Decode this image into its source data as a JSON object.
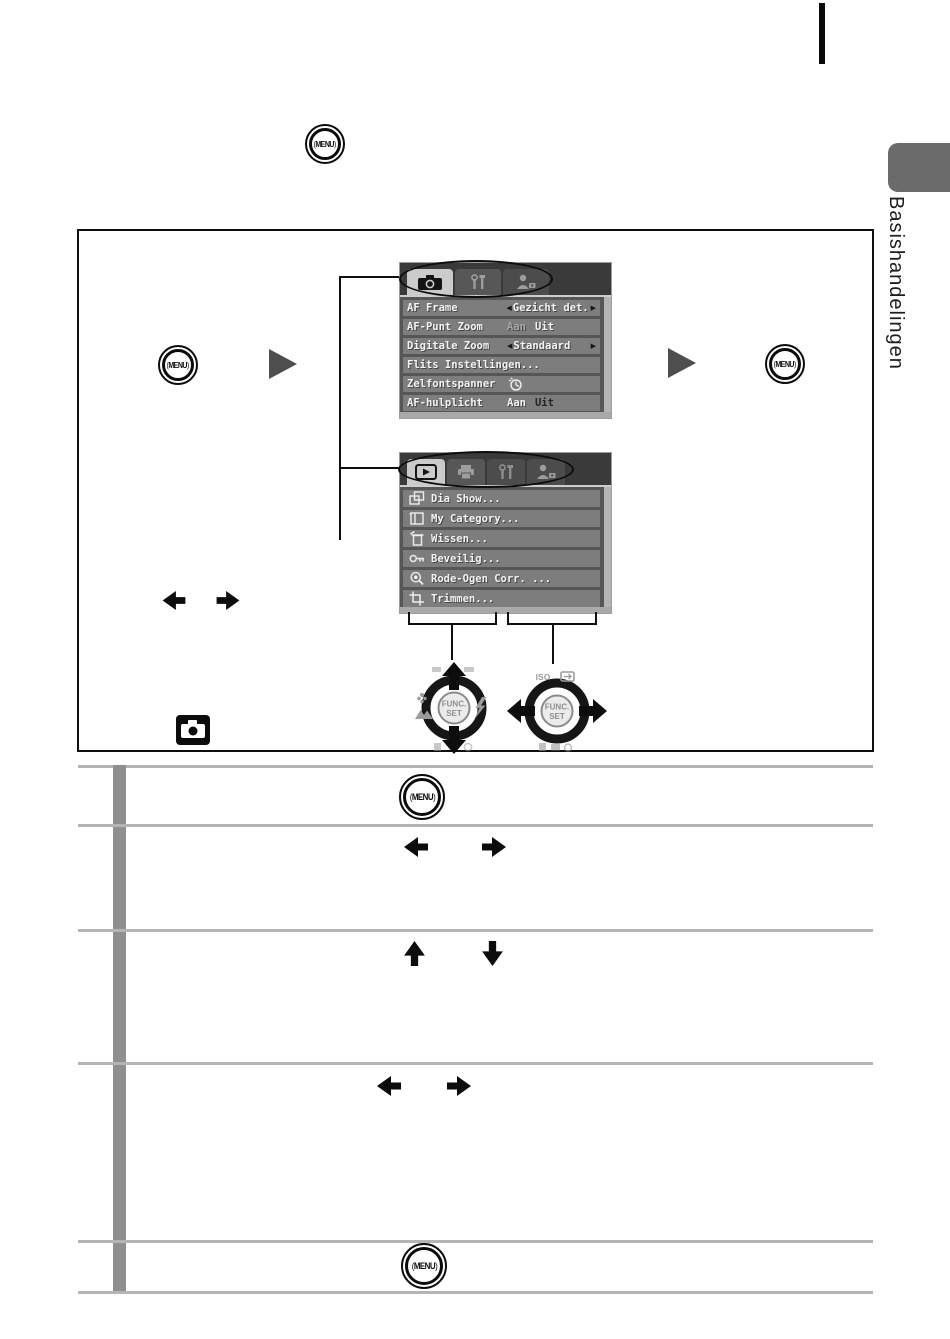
{
  "sidebar": {
    "label": "Basishandelingen"
  },
  "buttons": {
    "menu_label": "MENU"
  },
  "record_menu": {
    "tabs": [
      {
        "icon": "camera-icon"
      },
      {
        "icon": "setup-tools-icon"
      },
      {
        "icon": "my-camera-icon"
      }
    ],
    "rows": [
      {
        "label": "AF Frame",
        "value": "Gezicht det."
      },
      {
        "label": "AF-Punt Zoom",
        "opt1": "Aan",
        "opt2": "Uit",
        "selected": "Uit"
      },
      {
        "label": "Digitale Zoom",
        "value": "Standaard"
      },
      {
        "label": "Flits Instellingen..."
      },
      {
        "label": "Zelfontspanner",
        "value_icon": "self-timer-icon"
      },
      {
        "label": "AF-hulplicht",
        "opt1": "Aan",
        "opt2": "Uit",
        "selected": "Aan"
      }
    ]
  },
  "play_menu": {
    "tabs": [
      {
        "icon": "play-icon"
      },
      {
        "icon": "print-icon"
      },
      {
        "icon": "setup-tools-icon"
      },
      {
        "icon": "my-camera-icon"
      }
    ],
    "items": [
      {
        "icon": "slideshow-icon",
        "label": "Dia Show..."
      },
      {
        "icon": "category-icon",
        "label": "My Category..."
      },
      {
        "icon": "erase-icon",
        "label": "Wissen..."
      },
      {
        "icon": "protect-key-icon",
        "label": "Beveilig..."
      },
      {
        "icon": "red-eye-icon",
        "label": "Rode-Ogen Corr. ..."
      },
      {
        "icon": "trim-icon",
        "label": "Trimmen..."
      }
    ]
  },
  "dials": {
    "func_line1": "FUNC.",
    "func_line2": "SET",
    "iso_label": "ISO"
  }
}
